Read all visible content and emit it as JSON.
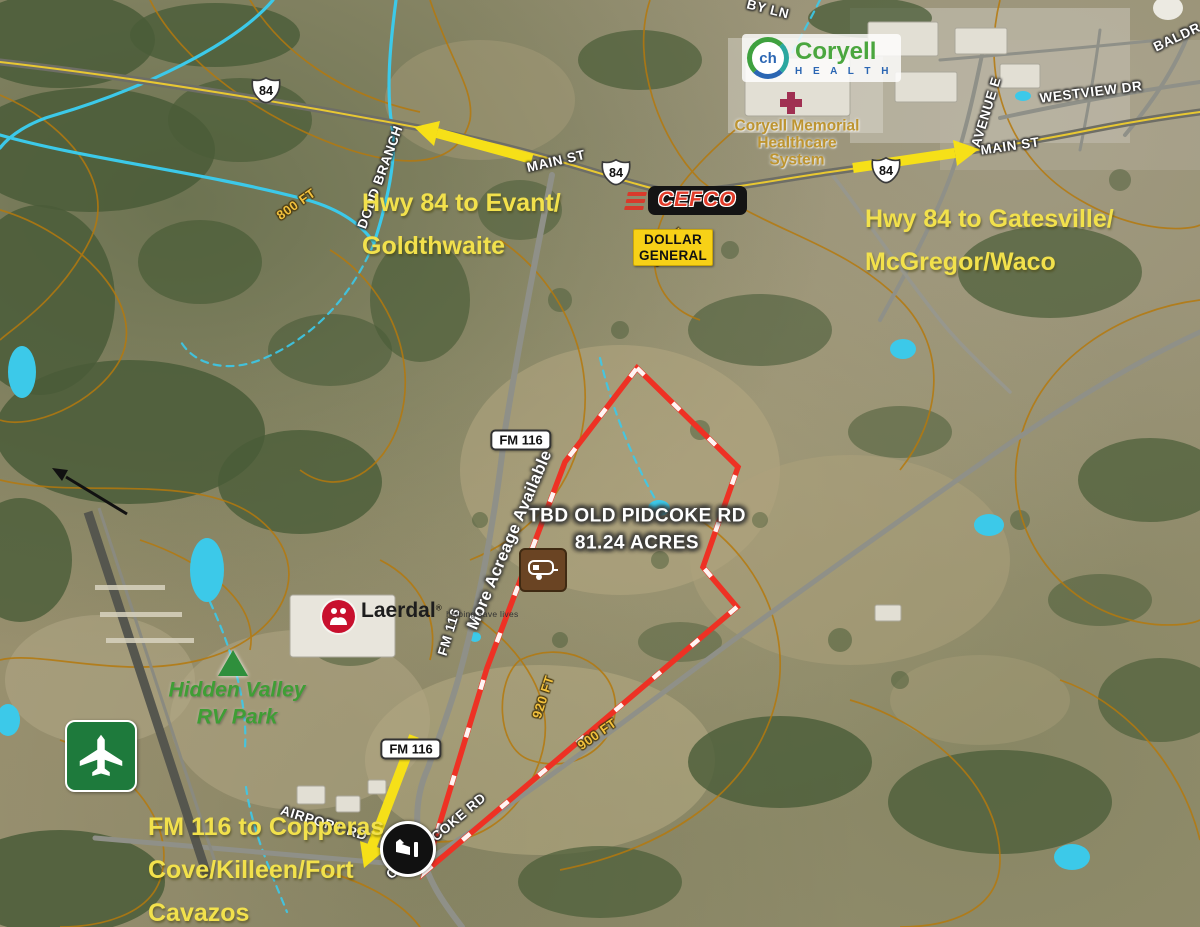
{
  "map": {
    "kind": "annotated aerial / satellite listing map",
    "property": {
      "line1": "TBD OLD PIDCOKE RD",
      "line2": "81.24 ACRES",
      "more_acreage": "More Acreage Available"
    },
    "callouts": {
      "evant": {
        "line1": "Hwy 84 to Evant/",
        "line2": "Goldthwaite"
      },
      "gatesville": {
        "line1": "Hwy 84 to Gatesville/",
        "line2": "McGregor/Waco"
      },
      "copperas": {
        "line1": "FM 116 to Copperas",
        "line2": "Cove/Killeen/Fort",
        "line3": "Cavazos"
      }
    },
    "roads": {
      "main_st_w": "MAIN ST",
      "main_st_e": "MAIN ST",
      "westview": "WESTVIEW DR",
      "avenue_e": "AVENUE E",
      "baldridge": "BALDR",
      "by_ln": "BY LN",
      "airport": "AIRPORT RD",
      "old_pidcoke": "OLD PIDCOKE RD",
      "fm116": "FM 116",
      "dodd_branch": "DODD BRANCH"
    },
    "shields": {
      "us84": "84",
      "fm116": "FM 116"
    },
    "contours": {
      "c800": "800 FT",
      "c880": "880 FT",
      "c900": "900 FT",
      "c920": "920 FT"
    },
    "businesses": {
      "cefco": "CEFCO",
      "dollar_general_1": "DOLLAR",
      "dollar_general_2": "GENERAL",
      "coryell_icon": "ch",
      "coryell_name": "Coryell",
      "coryell_health": "H E A L T H",
      "cmhs_1": "Coryell Memorial",
      "cmhs_2": "Healthcare",
      "cmhs_3": "System",
      "laerdal": "Laerdal",
      "laerdal_reg": "®",
      "laerdal_tag": "helping save lives",
      "hidden_valley_1": "Hidden Valley",
      "hidden_valley_2": "RV Park"
    },
    "icons": [
      "airport-icon",
      "rv-park-icon",
      "drive-in-theater-icon",
      "campground-tent-icon",
      "hospital-cross-icon",
      "coryell-health-logo",
      "laerdal-logo",
      "us-84-shield",
      "fm-116-shield",
      "north-arrow",
      "direction-arrow-yellow"
    ],
    "colors": {
      "annotation_yellow": "#f2e14c",
      "property_outline_red": "#ee3124",
      "arrow_yellow": "#f6e018",
      "water_cyan": "#3cc9e9",
      "contour_orange": "#b5790d",
      "highway_stripe_yellow": "#e8c832",
      "dollar_general_yellow": "#f7d117",
      "cefco_red": "#d93a2b",
      "coryell_green": "#4aa63e",
      "coryell_blue": "#2b66b3",
      "hidden_valley_green": "#3f9e35",
      "laerdal_red": "#c8102e",
      "cmhs_gold": "#bd9430"
    }
  }
}
